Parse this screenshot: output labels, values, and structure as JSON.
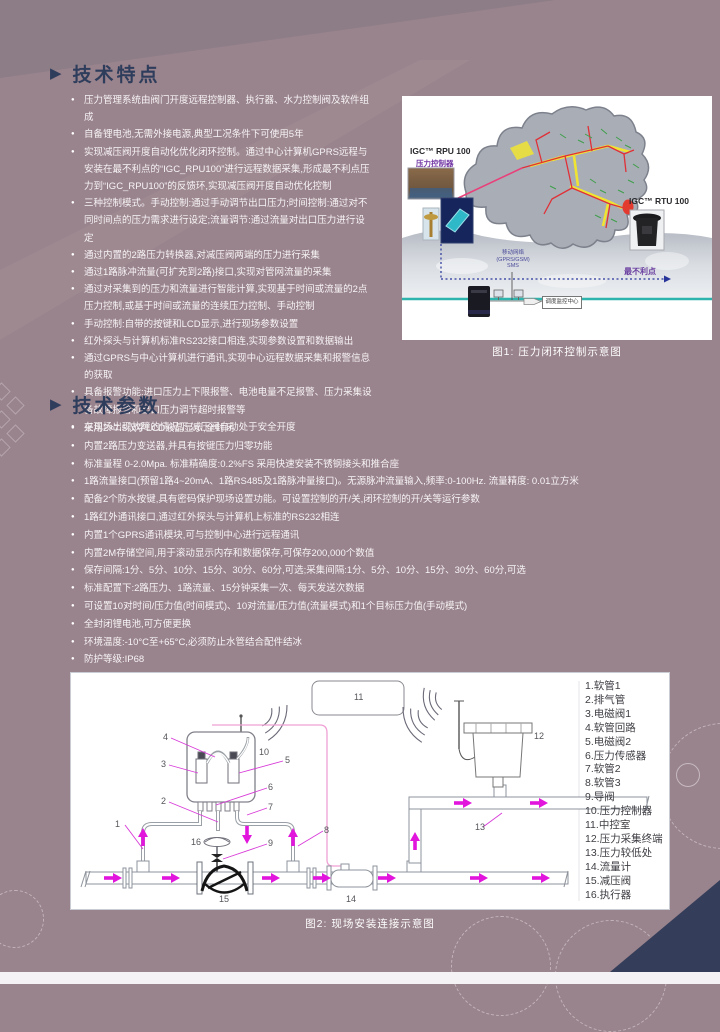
{
  "colors": {
    "background": "#99838C",
    "heading_navy": "#2E3D5C",
    "corner_navy": "#343D59",
    "bullet_text": "#F7F4F6",
    "magenta_arrow": "#E215DD",
    "teal_line": "#2FB3AD",
    "purple_label": "#6B3FA0",
    "map_red": "#E03038",
    "map_yellow": "#F0E432",
    "map_green": "#3F9E4A"
  },
  "features": {
    "title": "技术特点",
    "items": [
      "压力管理系统由阀门开度远程控制器、执行器、水力控制阀及软件组成",
      "自备锂电池,无需外接电源,典型工况条件下可使用5年",
      "实现减压阀开度自动化优化闭环控制。通过中心计算机GPRS远程与安装在最不利点的“IGC_RPU100”进行远程数据采集,形成最不利点压力到“IGC_RPU100”的反馈环,实现减压阀开度自动优化控制",
      "三种控制模式。手动控制:通过手动调节出口压力;时间控制:通过对不同时间点的压力需求进行设定;流量调节:通过流量对出口压力进行设定",
      "通过内置的2路压力转换器,对减压阀两端的压力进行采集",
      "通过1路脉冲流量(可扩充到2路)接口,实现对管网流量的采集",
      "通过对采集到的压力和流量进行智能计算,实现基于时间或流量的2点压力控制,或基于时间或流量的连续压力控制、手动控制",
      "手动控制:自带的按键和LCD显示,进行现场参数设置",
      "红外探头与计算机标准RS232接口相连,实现参数设置和数据输出",
      "通过GPRS与中心计算机进行通讯,实现中心远程数据采集和报警信息的获取",
      "具备报警功能:进口压力上下限报警、电池电量不足报警、压力采集设备故障报警和出口压力调节超时报警等",
      "在现场出现故障的情况下,减压阀自动处于安全开度"
    ]
  },
  "figure1": {
    "caption": "图1: 压力闭环控制示意图",
    "rpu_label": "IGC™ RPU 100",
    "rpu_sublabel": "压力控制器",
    "rtu_label": "IGC™ RTU 100",
    "worst_point_label": "最不利点",
    "network_label_line1": "移动网络",
    "network_label_line2": "(GPRS/GSM)",
    "network_label_line3": "SMS",
    "center_box_label": "调度监控中心"
  },
  "params": {
    "title": "技术参数",
    "items": [
      "采用2×7.5汉字LCD液晶显示,全封闭",
      "内置2路压力变送器,并具有按键压力归零功能",
      "标准量程 0-2.0Mpa. 标准精确度:0.2%FS  采用快速安装不锈钢接头和推合座",
      "1路流量接口(预留1路4~20mA、1路RS485及1路脉冲量接口)。无源脉冲流量输入,频率:0-100Hz. 流量精度: 0.01立方米",
      "配备2个防水按键,具有密码保护现场设置功能。可设置控制的开/关,闭环控制的开/关等运行参数",
      "1路红外通讯接口,通过红外探头与计算机上标准的RS232相连",
      "内置1个GPRS通讯模块,可与控制中心进行远程通讯",
      "内置2M存储空间,用于滚动显示内存和数据保存,可保存200,000个数值",
      "保存间隔:1分、5分、10分、15分、30分、60分,可选;采集间隔:1分、5分、10分、15分、30分、60分,可选",
      "标准配置下:2路压力、1路流量、15分钟采集一次、每天发送次数据",
      "可设置10对时间/压力值(时间模式)、10对流量/压力值(流量模式)和1个目标压力值(手动模式)",
      "全封闭锂电池,可方便更换",
      "环境温度:-10°C至+65°C,必须防止水管结合配件结冰",
      "防护等级:IP68"
    ]
  },
  "figure2": {
    "caption": "图2: 现场安装连接示意图",
    "numbers": [
      "1",
      "2",
      "3",
      "4",
      "5",
      "6",
      "7",
      "8",
      "9",
      "10",
      "11",
      "12",
      "13",
      "14",
      "15",
      "16"
    ],
    "legend": [
      "1.软管1",
      "2.排气管",
      "3.电磁阀1",
      "4.软管回路",
      "5.电磁阀2",
      "6.压力传感器",
      "7.软管2",
      "8.软管3",
      "9.导阀",
      "10.压力控制器",
      "11.中控室",
      "12.压力采集终端",
      "13.压力较低处",
      "14.流量计",
      "15.减压阀",
      "16.执行器"
    ]
  }
}
